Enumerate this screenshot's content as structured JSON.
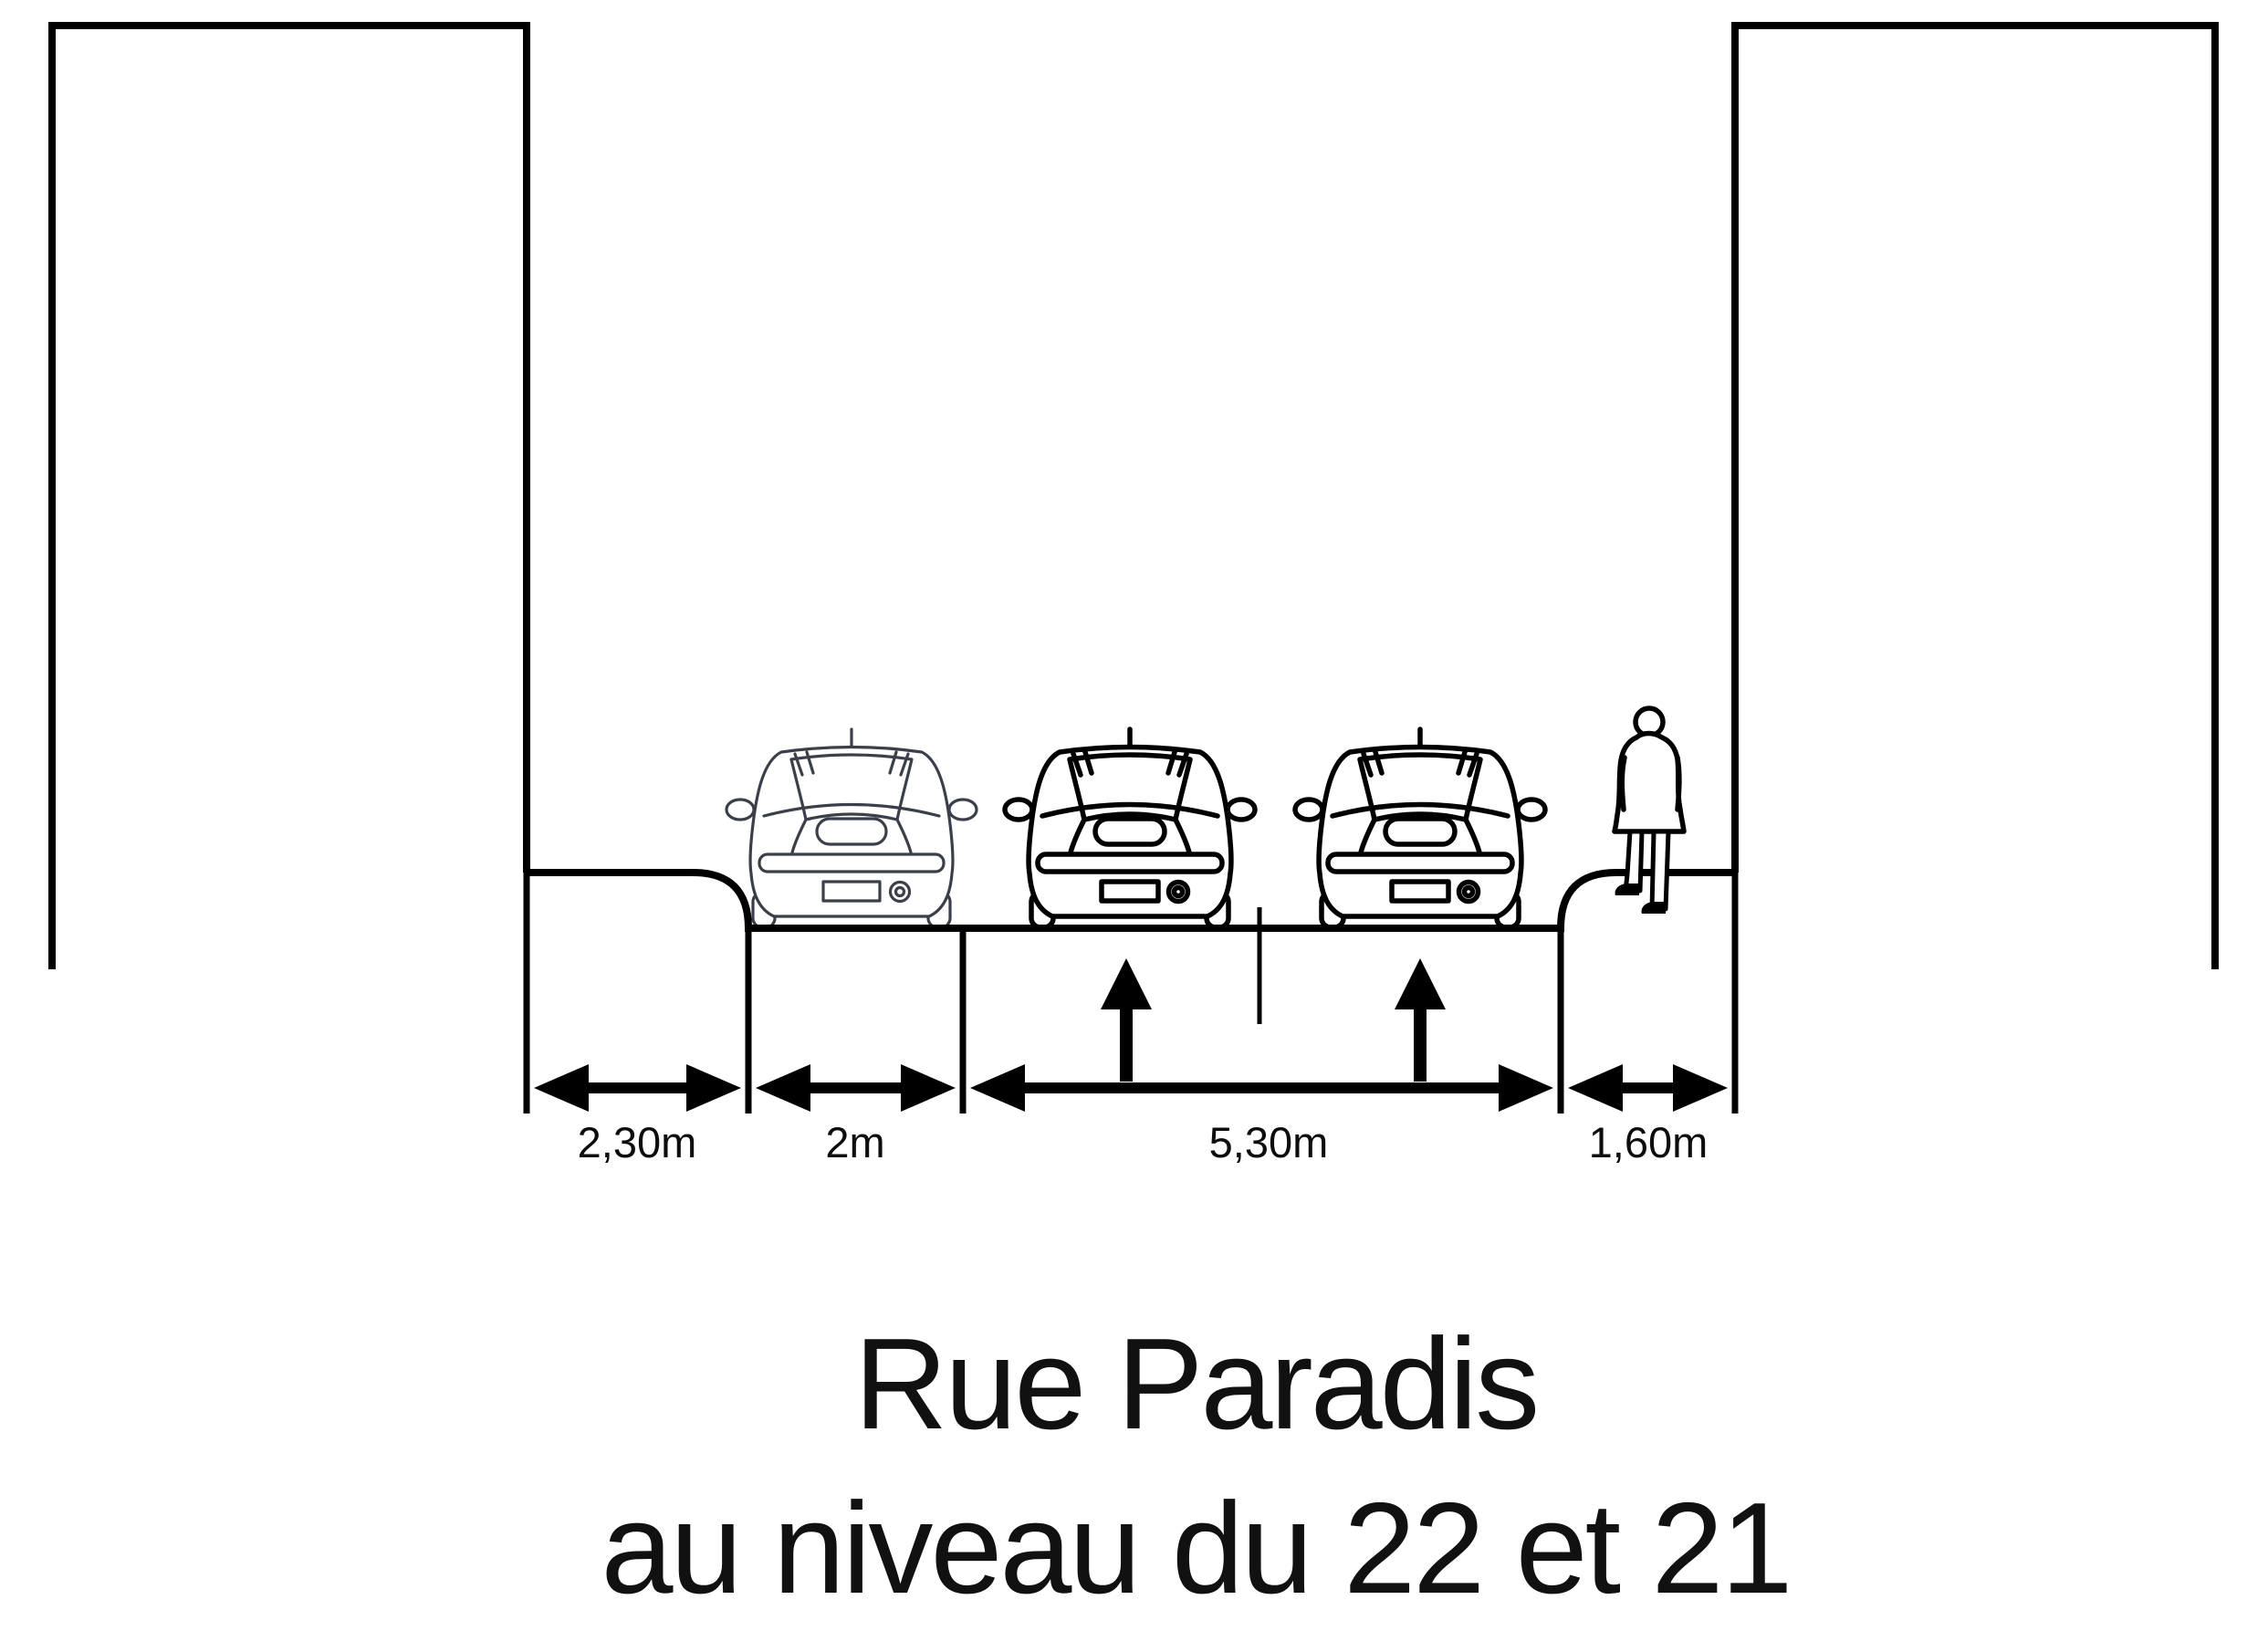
{
  "page": {
    "background": "#ffffff",
    "ink_color": "#000000",
    "parked_car_outline_color": "#3a3f4a",
    "moving_car_outline_color": "#000000"
  },
  "diagram": {
    "title": {
      "line1": "Rue Paradis",
      "line2": "au niveau du 22 et 21"
    },
    "sections": [
      {
        "name": "left-sidewalk",
        "width_label": "2,30m"
      },
      {
        "name": "parking-lane",
        "width_label": "2m"
      },
      {
        "name": "roadway",
        "width_label": "5,30m"
      },
      {
        "name": "right-sidewalk",
        "width_label": "1,60m"
      }
    ]
  }
}
